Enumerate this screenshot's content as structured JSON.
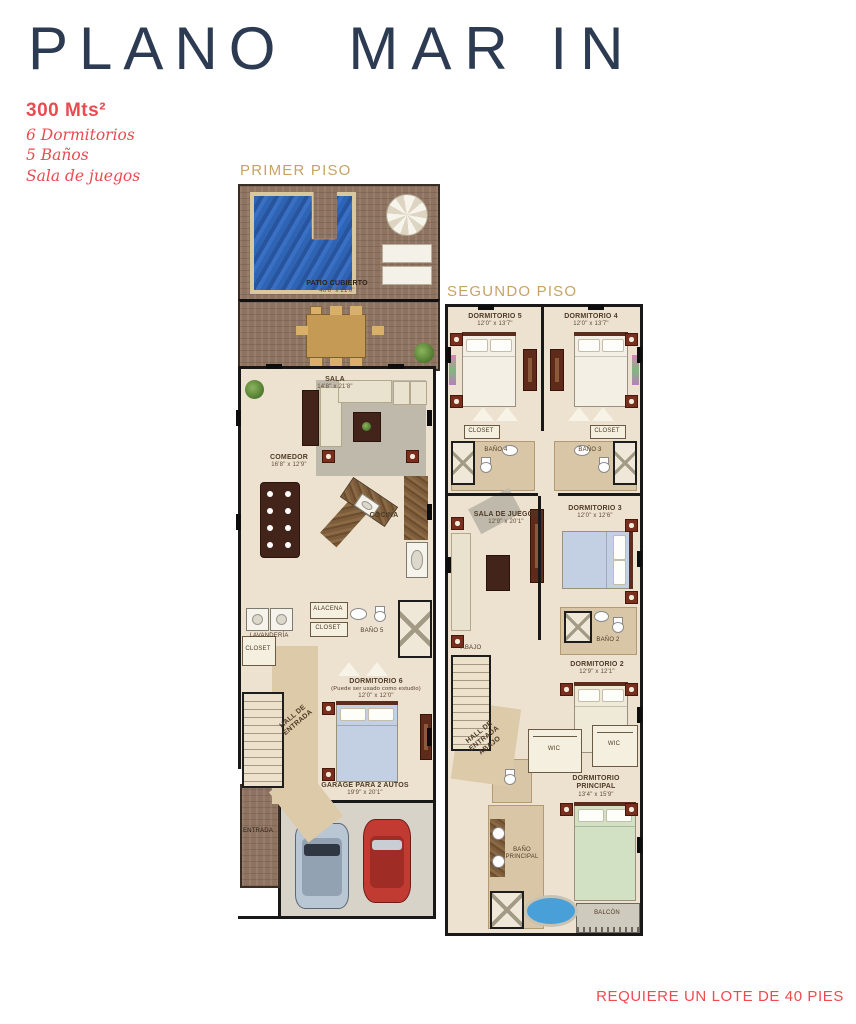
{
  "header": {
    "title_left": "PLANO",
    "title_right": "MAR IN"
  },
  "specs": {
    "area": "300 Mts²",
    "line1": "6 Dormitorios",
    "line2": "5 Baños",
    "line3": "Sala de juegos"
  },
  "footer": {
    "note": "REQUIERE UN LOTE DE 40 PIES"
  },
  "floor1": {
    "heading": "PRIMER PISO",
    "patio": {
      "label": "PATIO CUBIERTO",
      "dims": "40'0\" x 21'0\""
    },
    "sala": {
      "label": "SALA",
      "dims": "14'8\" x 21'8\""
    },
    "comedor": {
      "label": "COMEDOR",
      "dims": "16'8\" x 12'9\""
    },
    "cocina": {
      "label": "COCINA"
    },
    "lavanderia": {
      "label": "Lavandería"
    },
    "alacena": {
      "label": "Alacena"
    },
    "closet": {
      "label": "Closet"
    },
    "closet_bano": {
      "label": "Closet"
    },
    "bano5": {
      "label": "Baño 5"
    },
    "dorm6": {
      "label": "DORMITORIO 6",
      "sub": "(Puede ser usado como estudio)",
      "dims": "12'0\" x 12'0\""
    },
    "hall": {
      "label": "HALL DE ENTRADA"
    },
    "garage": {
      "label": "GARAGE PARA 2 AUTOS",
      "dims": "19'9\" x 20'1\""
    },
    "entrada": {
      "label": "ENTRADA"
    }
  },
  "floor2": {
    "heading": "SEGUNDO PISO",
    "dorm5": {
      "label": "DORMITORIO 5",
      "dims": "12'0\" x 13'7\""
    },
    "dorm4": {
      "label": "DORMITORIO 4",
      "dims": "12'0\" x 13'7\""
    },
    "closet_izq": {
      "label": "Closet"
    },
    "closet_der": {
      "label": "Closet"
    },
    "bano4": {
      "label": "Baño 4"
    },
    "bano3": {
      "label": "Baño 3"
    },
    "sala_juegos": {
      "label": "SALA DE JUEGOS",
      "dims": "12'9\" x 20'1\""
    },
    "dorm3": {
      "label": "DORMITORIO 3",
      "dims": "12'0\" x 12'6\""
    },
    "bano2": {
      "label": "Baño 2"
    },
    "dorm2": {
      "label": "DORMITORIO 2",
      "dims": "12'9\" x 12'1\""
    },
    "abajo": {
      "label": "Abajo"
    },
    "hall_abajo": {
      "label": "HALL DE ENTRADA ABAJO"
    },
    "wic1": {
      "label": "WIC"
    },
    "wic2": {
      "label": "WIC"
    },
    "principal": {
      "label": "DORMITORIO PRINCIPAL",
      "dims": "13'4\" x 15'9\""
    },
    "bano_principal": {
      "label": "Baño Principal"
    },
    "balcon": {
      "label": "Balcón"
    }
  },
  "colors": {
    "accent_red": "#e94b50",
    "heading_tan": "#c8a263",
    "title_navy": "#2d3b52"
  }
}
